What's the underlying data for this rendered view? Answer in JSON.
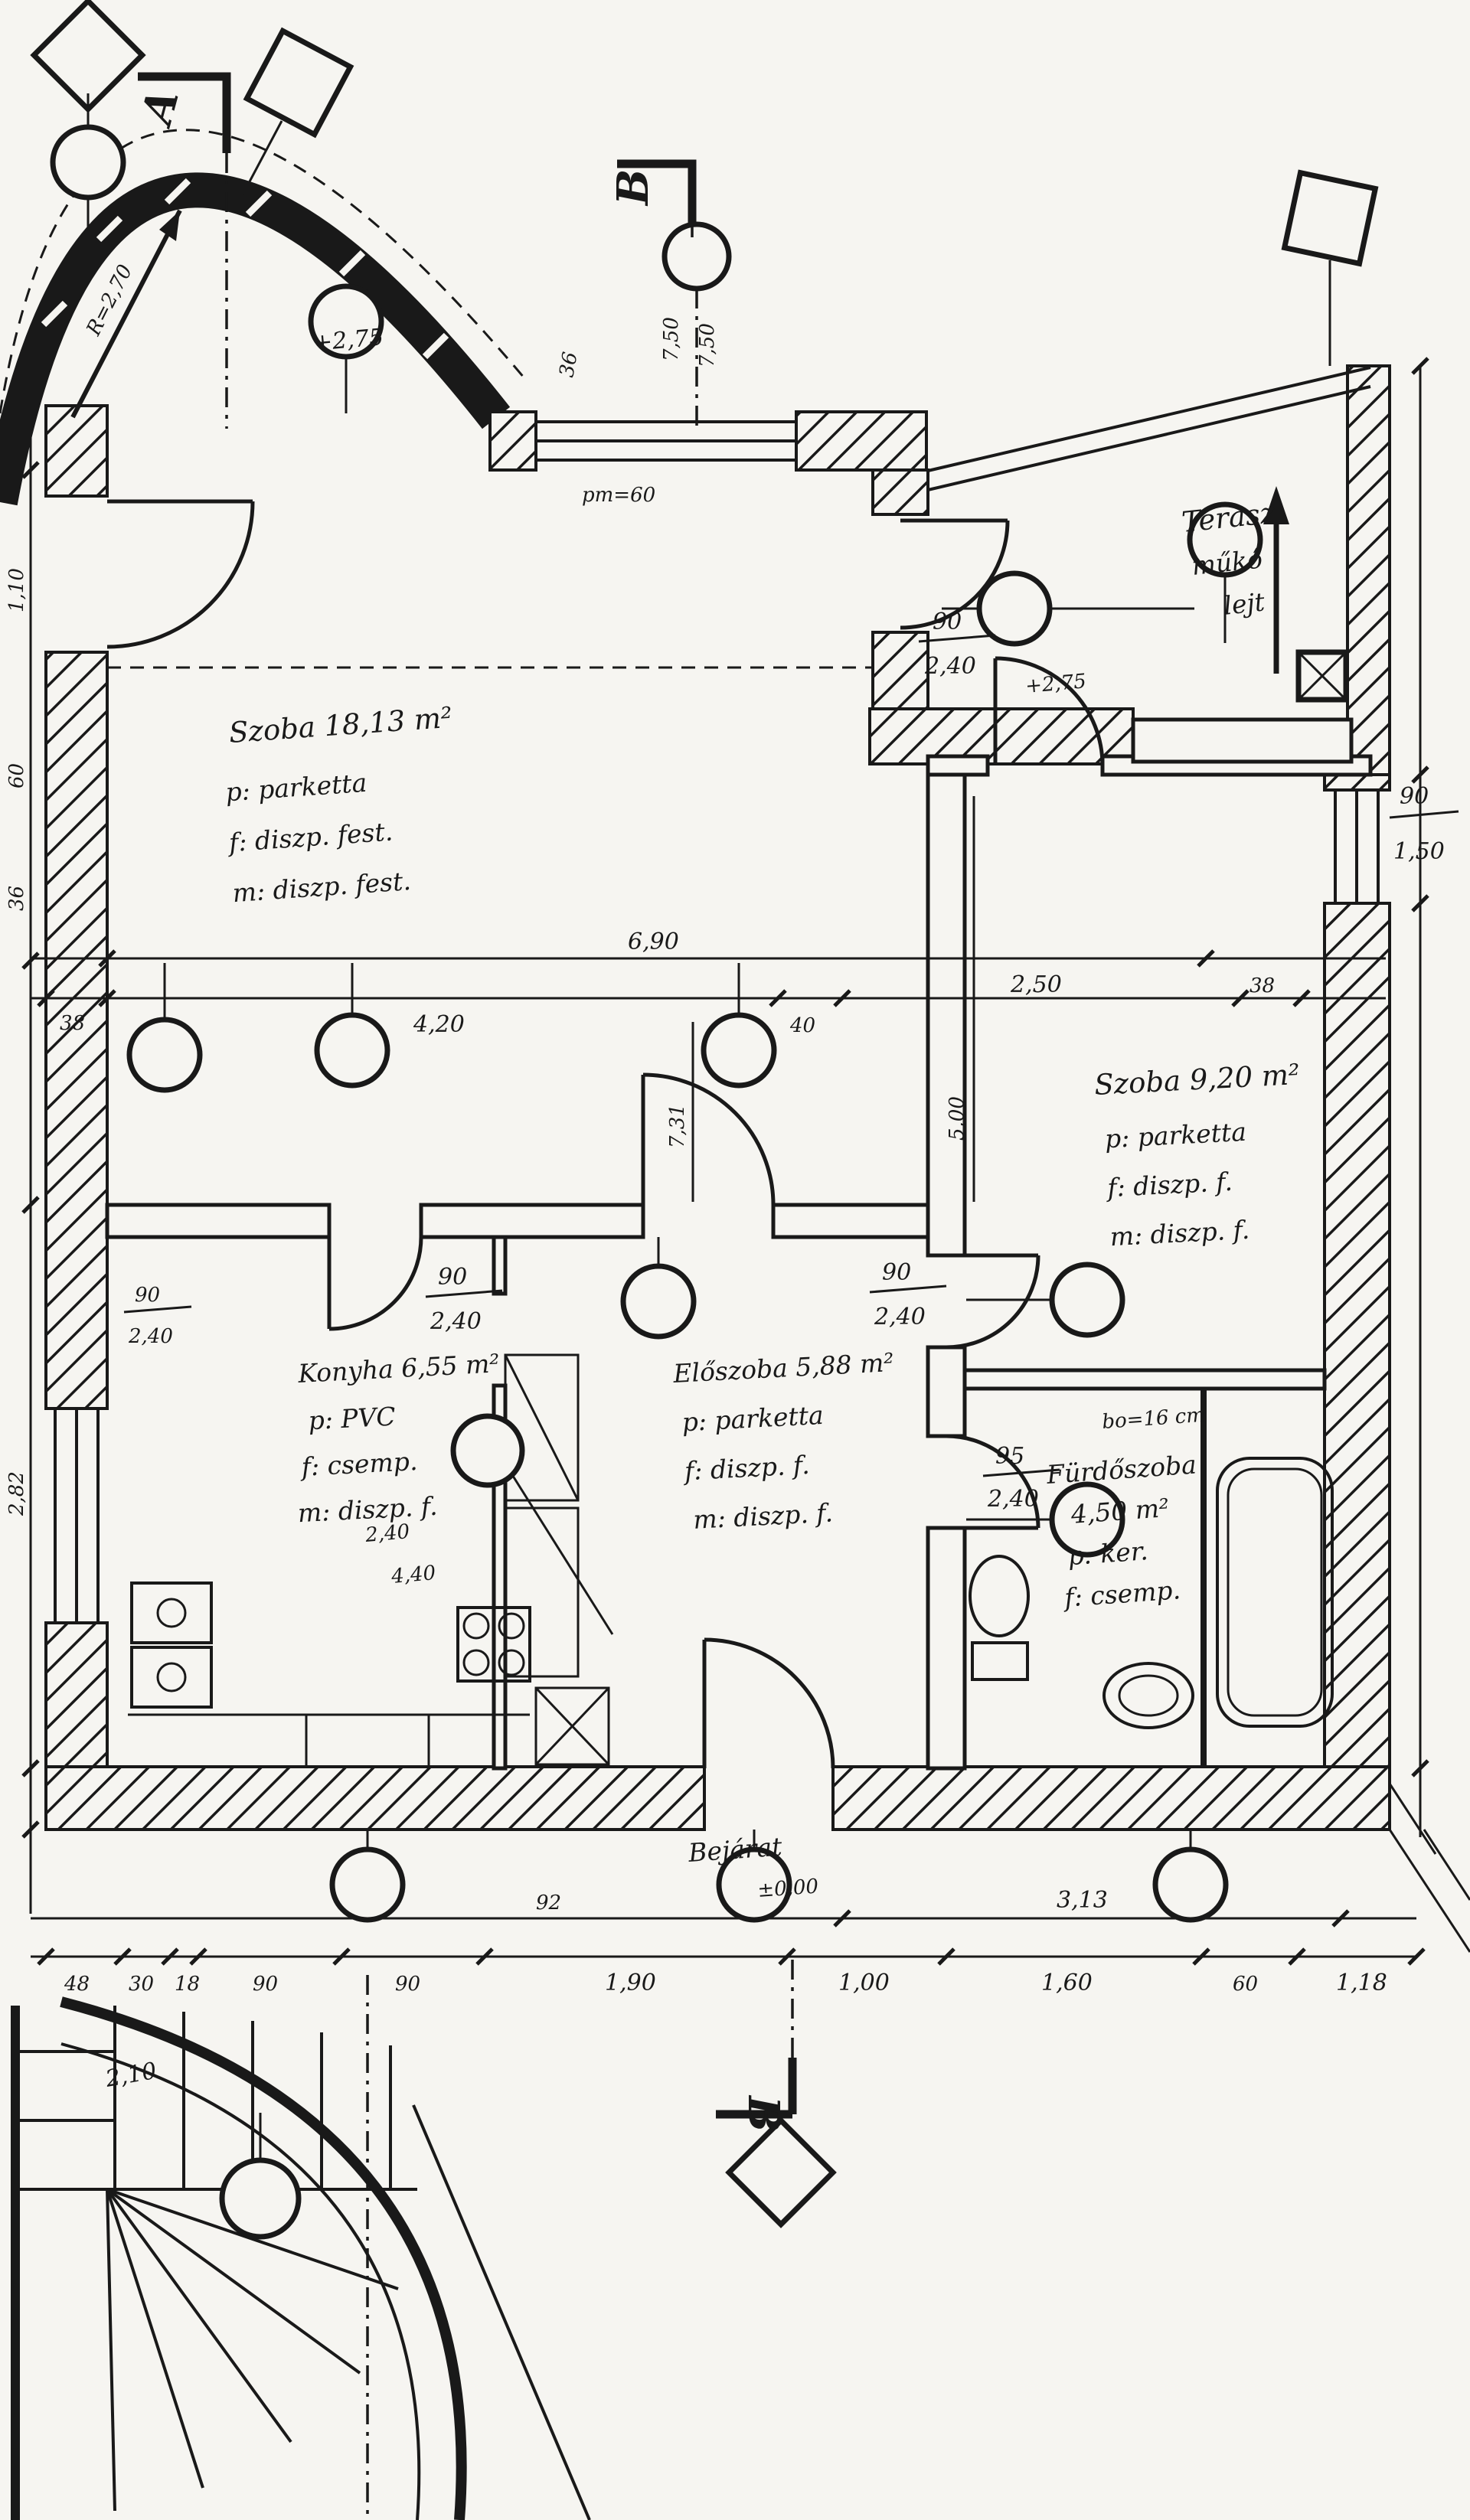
{
  "colors": {
    "ink": "#191919",
    "paper": "#f6f5f1"
  },
  "rooms": {
    "r1": {
      "title": "Szoba 18,13 m²",
      "l1": "p: parketta",
      "l2": "f: diszp. fest.",
      "l3": "m: diszp. fest."
    },
    "r2": {
      "title": "Szoba 9,20 m²",
      "l1": "p: parketta",
      "l2": "f: diszp. f.",
      "l3": "m: diszp. f."
    },
    "terrace": {
      "t1": "Terasz",
      "t2": "műkő",
      "t3": "lejt"
    },
    "konyha": {
      "title": "Konyha 6,55 m²",
      "l1": "p: PVC",
      "l2": "f: csemp.",
      "l3": "m: diszp. f."
    },
    "eloszoba": {
      "title": "Előszoba 5,88 m²",
      "l1": "p: parketta",
      "l2": "f: diszp. f.",
      "l3": "m: diszp. f."
    },
    "furdo": {
      "l1": "Fürdőszoba",
      "l2": "4,50 m²",
      "l3": "p: ker.",
      "l4": "f: csemp."
    }
  },
  "doors": {
    "terrace_door": {
      "w": "90",
      "h": "2,40"
    },
    "kitchen_door": {
      "w": "90",
      "h": "2,40"
    },
    "room2_door": {
      "w": "90",
      "h": "2,40"
    },
    "bath_door": {
      "w": "95",
      "h": "2,40"
    },
    "left_pair": {
      "w": "90",
      "h": "2,40"
    },
    "window_right": {
      "w": "90",
      "h": "1,50"
    }
  },
  "dims_mid": {
    "total": "6,90",
    "a": "38",
    "b": "4,20",
    "c": "40",
    "d": "2,50",
    "e": "38"
  },
  "dims_bottom": {
    "a": "48",
    "b": "30",
    "c": "18",
    "d": "90",
    "e": "90",
    "f": "1,90",
    "g": "1,00",
    "h": "92",
    "total_right": "3,13",
    "i": "1,60",
    "j": "60",
    "k": "1,18"
  },
  "dims_left": {
    "a": "1,10",
    "b": "60",
    "c": "36",
    "d": "2,82"
  },
  "dims_vert": {
    "a": "7,31",
    "b": "5,00"
  },
  "levels": {
    "l1": "+2,75",
    "l2": "+2,75",
    "l0": "±0,00"
  },
  "annotations": {
    "pm": "pm=60",
    "bo": "bo=16 cm",
    "radius": "R=2,70",
    "bejarat": "Bejárat",
    "k1": "2,40",
    "k2": "4,40",
    "stair": "2,10",
    "b36": "36",
    "b750a": "7,50",
    "b750b": "7,50"
  },
  "sections": {
    "a": "A",
    "b1": "B",
    "b2": "B"
  }
}
